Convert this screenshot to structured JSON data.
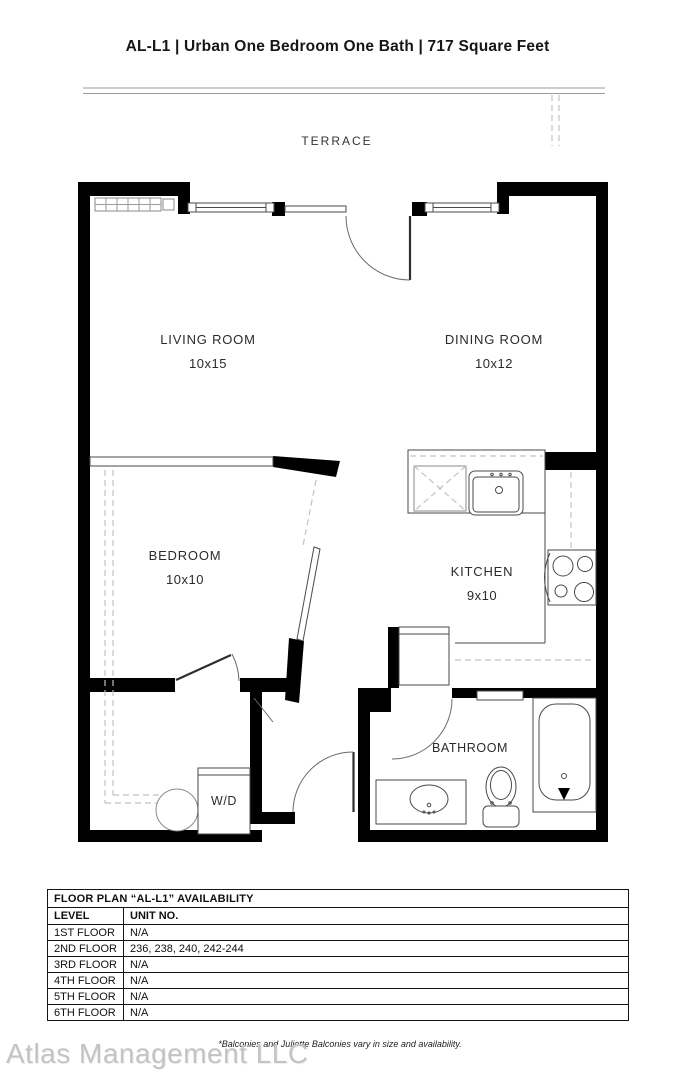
{
  "title": "AL-L1 | Urban One Bedroom One Bath | 717 Square Feet",
  "plan": {
    "terrace_label": "TERRACE",
    "rooms": {
      "living": {
        "name": "LIVING ROOM",
        "dims": "10x15"
      },
      "dining": {
        "name": "DINING ROOM",
        "dims": "10x12"
      },
      "bedroom": {
        "name": "BEDROOM",
        "dims": "10x10"
      },
      "kitchen": {
        "name": "KITCHEN",
        "dims": "9x10"
      },
      "bathroom": {
        "name": "BATHROOM"
      },
      "laundry": {
        "name": "W/D"
      }
    }
  },
  "availability_table": {
    "title": "FLOOR PLAN “AL-L1” AVAILABILITY",
    "columns": [
      "LEVEL",
      "UNIT NO."
    ],
    "rows": [
      {
        "level": "1ST FLOOR",
        "units": "N/A"
      },
      {
        "level": "2ND FLOOR",
        "units": "236, 238, 240, 242-244"
      },
      {
        "level": "3RD FLOOR",
        "units": "N/A"
      },
      {
        "level": "4TH FLOOR",
        "units": "N/A"
      },
      {
        "level": "5TH FLOOR",
        "units": "N/A"
      },
      {
        "level": "6TH FLOOR",
        "units": "N/A"
      }
    ]
  },
  "footnote": "*Balconies and Juliette Balconies vary in size and availability.",
  "watermark": "Atlas Management LLC",
  "colors": {
    "wall": "#000000",
    "line": "#4a4a4a",
    "dash": "#c2c2c2",
    "text": "#2b2b2b",
    "watermark": "#c3c3c3"
  }
}
